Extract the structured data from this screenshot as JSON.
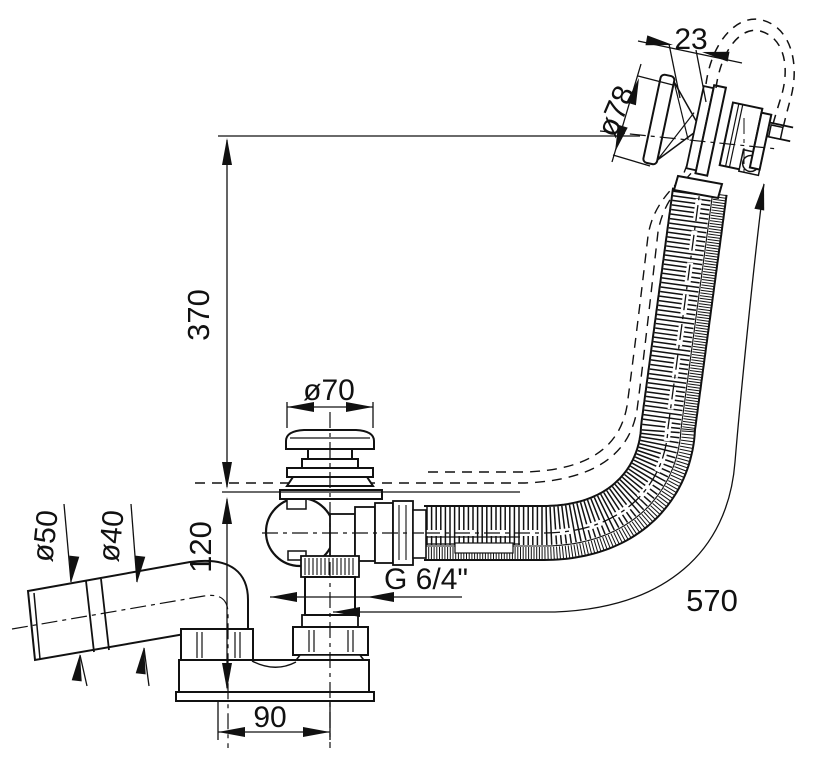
{
  "diagram": {
    "type": "technical-drawing",
    "colors": {
      "line": "#111111",
      "background": "#ffffff"
    },
    "dimensions": {
      "knob_offset": "23",
      "knob_diameter": "ø78",
      "overflow_height": "370",
      "plug_diameter": "ø70",
      "outlet_outer_diameter": "ø50",
      "outlet_inner_diameter": "ø40",
      "body_depth": "120",
      "thread_size": "G 6/4\"",
      "cable_length": "570",
      "outlet_spacing": "90"
    }
  }
}
